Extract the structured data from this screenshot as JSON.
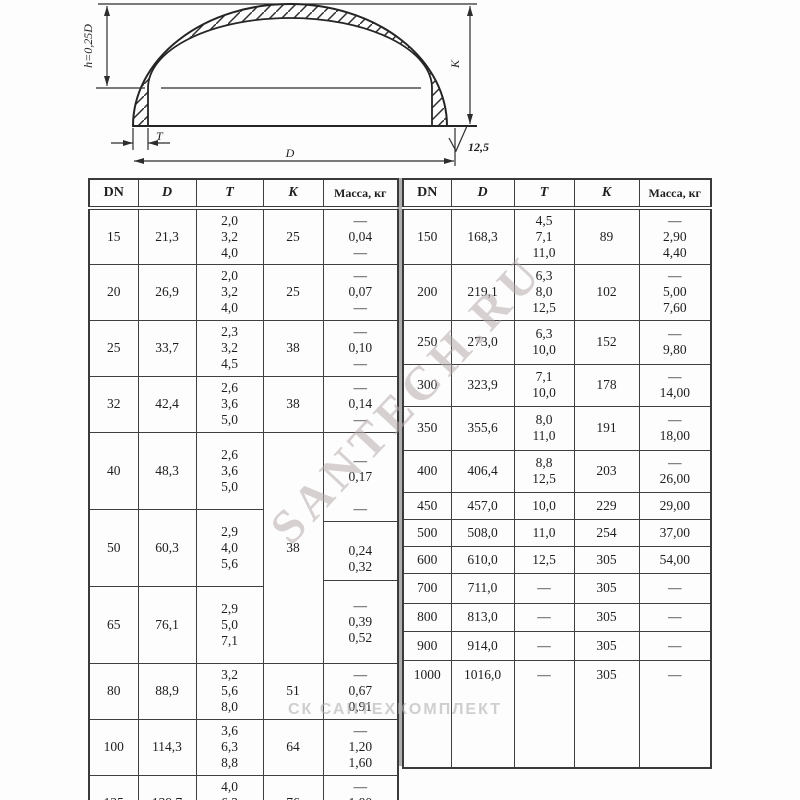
{
  "page": {
    "background": "#fdfdfd",
    "line_color": "#3a3a3a",
    "text_color": "#1e1e1e",
    "watermark_color": "#b8acac"
  },
  "drawing": {
    "h_dimension_label": "h=0,25D",
    "k_dimension_label": "K",
    "t_dimension_label": "T",
    "d_dimension_label": "D",
    "roughness_value": "12,5"
  },
  "watermarks": {
    "diagonal": "SANTECH.RU",
    "bottom": "СК САНТЕХКОМПЛЕКТ"
  },
  "left_table": {
    "headers": [
      "DN",
      "D",
      "T",
      "K",
      "Масса, кг"
    ],
    "rows": [
      {
        "dn": "15",
        "d": "21,3",
        "t": "2,0\n3,2\n4,0",
        "k": "25",
        "mass": "—\n0,04\n—"
      },
      {
        "dn": "20",
        "d": "26,9",
        "t": "2,0\n3,2\n4,0",
        "k": "25",
        "mass": "—\n0,07\n—"
      },
      {
        "dn": "25",
        "d": "33,7",
        "t": "2,3\n3,2\n4,5",
        "k": "38",
        "mass": "—\n0,10\n—"
      },
      {
        "dn": "32",
        "d": "42,4",
        "t": "2,6\n3,6\n5,0",
        "k": "38",
        "mass": "—\n0,14\n—"
      },
      {
        "dn": "40",
        "d": "48,3",
        "t": "2,6\n3,6\n5,0",
        "k": "38",
        "mass": "—\n0,17\n\n—"
      },
      {
        "dn": "50",
        "d": "60,3",
        "t": "2,9\n4,0\n5,6",
        "mass": "0,24\n0,32"
      },
      {
        "dn": "65",
        "d": "76,1",
        "t": "2,9\n5,0\n7,1",
        "mass": "—\n0,39\n0,52"
      },
      {
        "dn": "80",
        "d": "88,9",
        "t": "3,2\n5,6\n8,0",
        "k": "51",
        "mass": "—\n0,67\n0,91"
      },
      {
        "dn": "100",
        "d": "114,3",
        "t": "3,6\n6,3\n8,8",
        "k": "64",
        "mass": "—\n1,20\n1,60"
      },
      {
        "dn": "125",
        "d": "139,7",
        "t": "4,0\n6,3\n10,0",
        "k": "76",
        "mass": "—\n1,80\n2,80"
      }
    ]
  },
  "right_table": {
    "headers": [
      "DN",
      "D",
      "T",
      "K",
      "Масса, кг"
    ],
    "rows": [
      {
        "dn": "150",
        "d": "168,3",
        "t": "4,5\n7,1\n11,0",
        "k": "89",
        "mass": "—\n2,90\n4,40"
      },
      {
        "dn": "200",
        "d": "219,1",
        "t": "6,3\n8,0\n12,5",
        "k": "102",
        "mass": "—\n5,00\n7,60"
      },
      {
        "dn": "250",
        "d": "273,0",
        "t": "6,3\n10,0",
        "k": "152",
        "mass": "—\n9,80"
      },
      {
        "dn": "300",
        "d": "323,9",
        "t": "7,1\n10,0",
        "k": "178",
        "mass": "—\n14,00"
      },
      {
        "dn": "350",
        "d": "355,6",
        "t": "8,0\n11,0",
        "k": "191",
        "mass": "—\n18,00"
      },
      {
        "dn": "400",
        "d": "406,4",
        "t": "8,8\n12,5",
        "k": "203",
        "mass": "—\n26,00"
      },
      {
        "dn": "450",
        "d": "457,0",
        "t": "10,0",
        "k": "229",
        "mass": "29,00"
      },
      {
        "dn": "500",
        "d": "508,0",
        "t": "11,0",
        "k": "254",
        "mass": "37,00"
      },
      {
        "dn": "600",
        "d": "610,0",
        "t": "12,5",
        "k": "305",
        "mass": "54,00"
      },
      {
        "dn": "700",
        "d": "711,0",
        "t": "—",
        "k": "305",
        "mass": "—"
      },
      {
        "dn": "800",
        "d": "813,0",
        "t": "—",
        "k": "305",
        "mass": "—"
      },
      {
        "dn": "900",
        "d": "914,0",
        "t": "—",
        "k": "305",
        "mass": "—"
      },
      {
        "dn": "1000",
        "d": "1016,0",
        "t": "—",
        "k": "305",
        "mass": "—"
      }
    ]
  }
}
